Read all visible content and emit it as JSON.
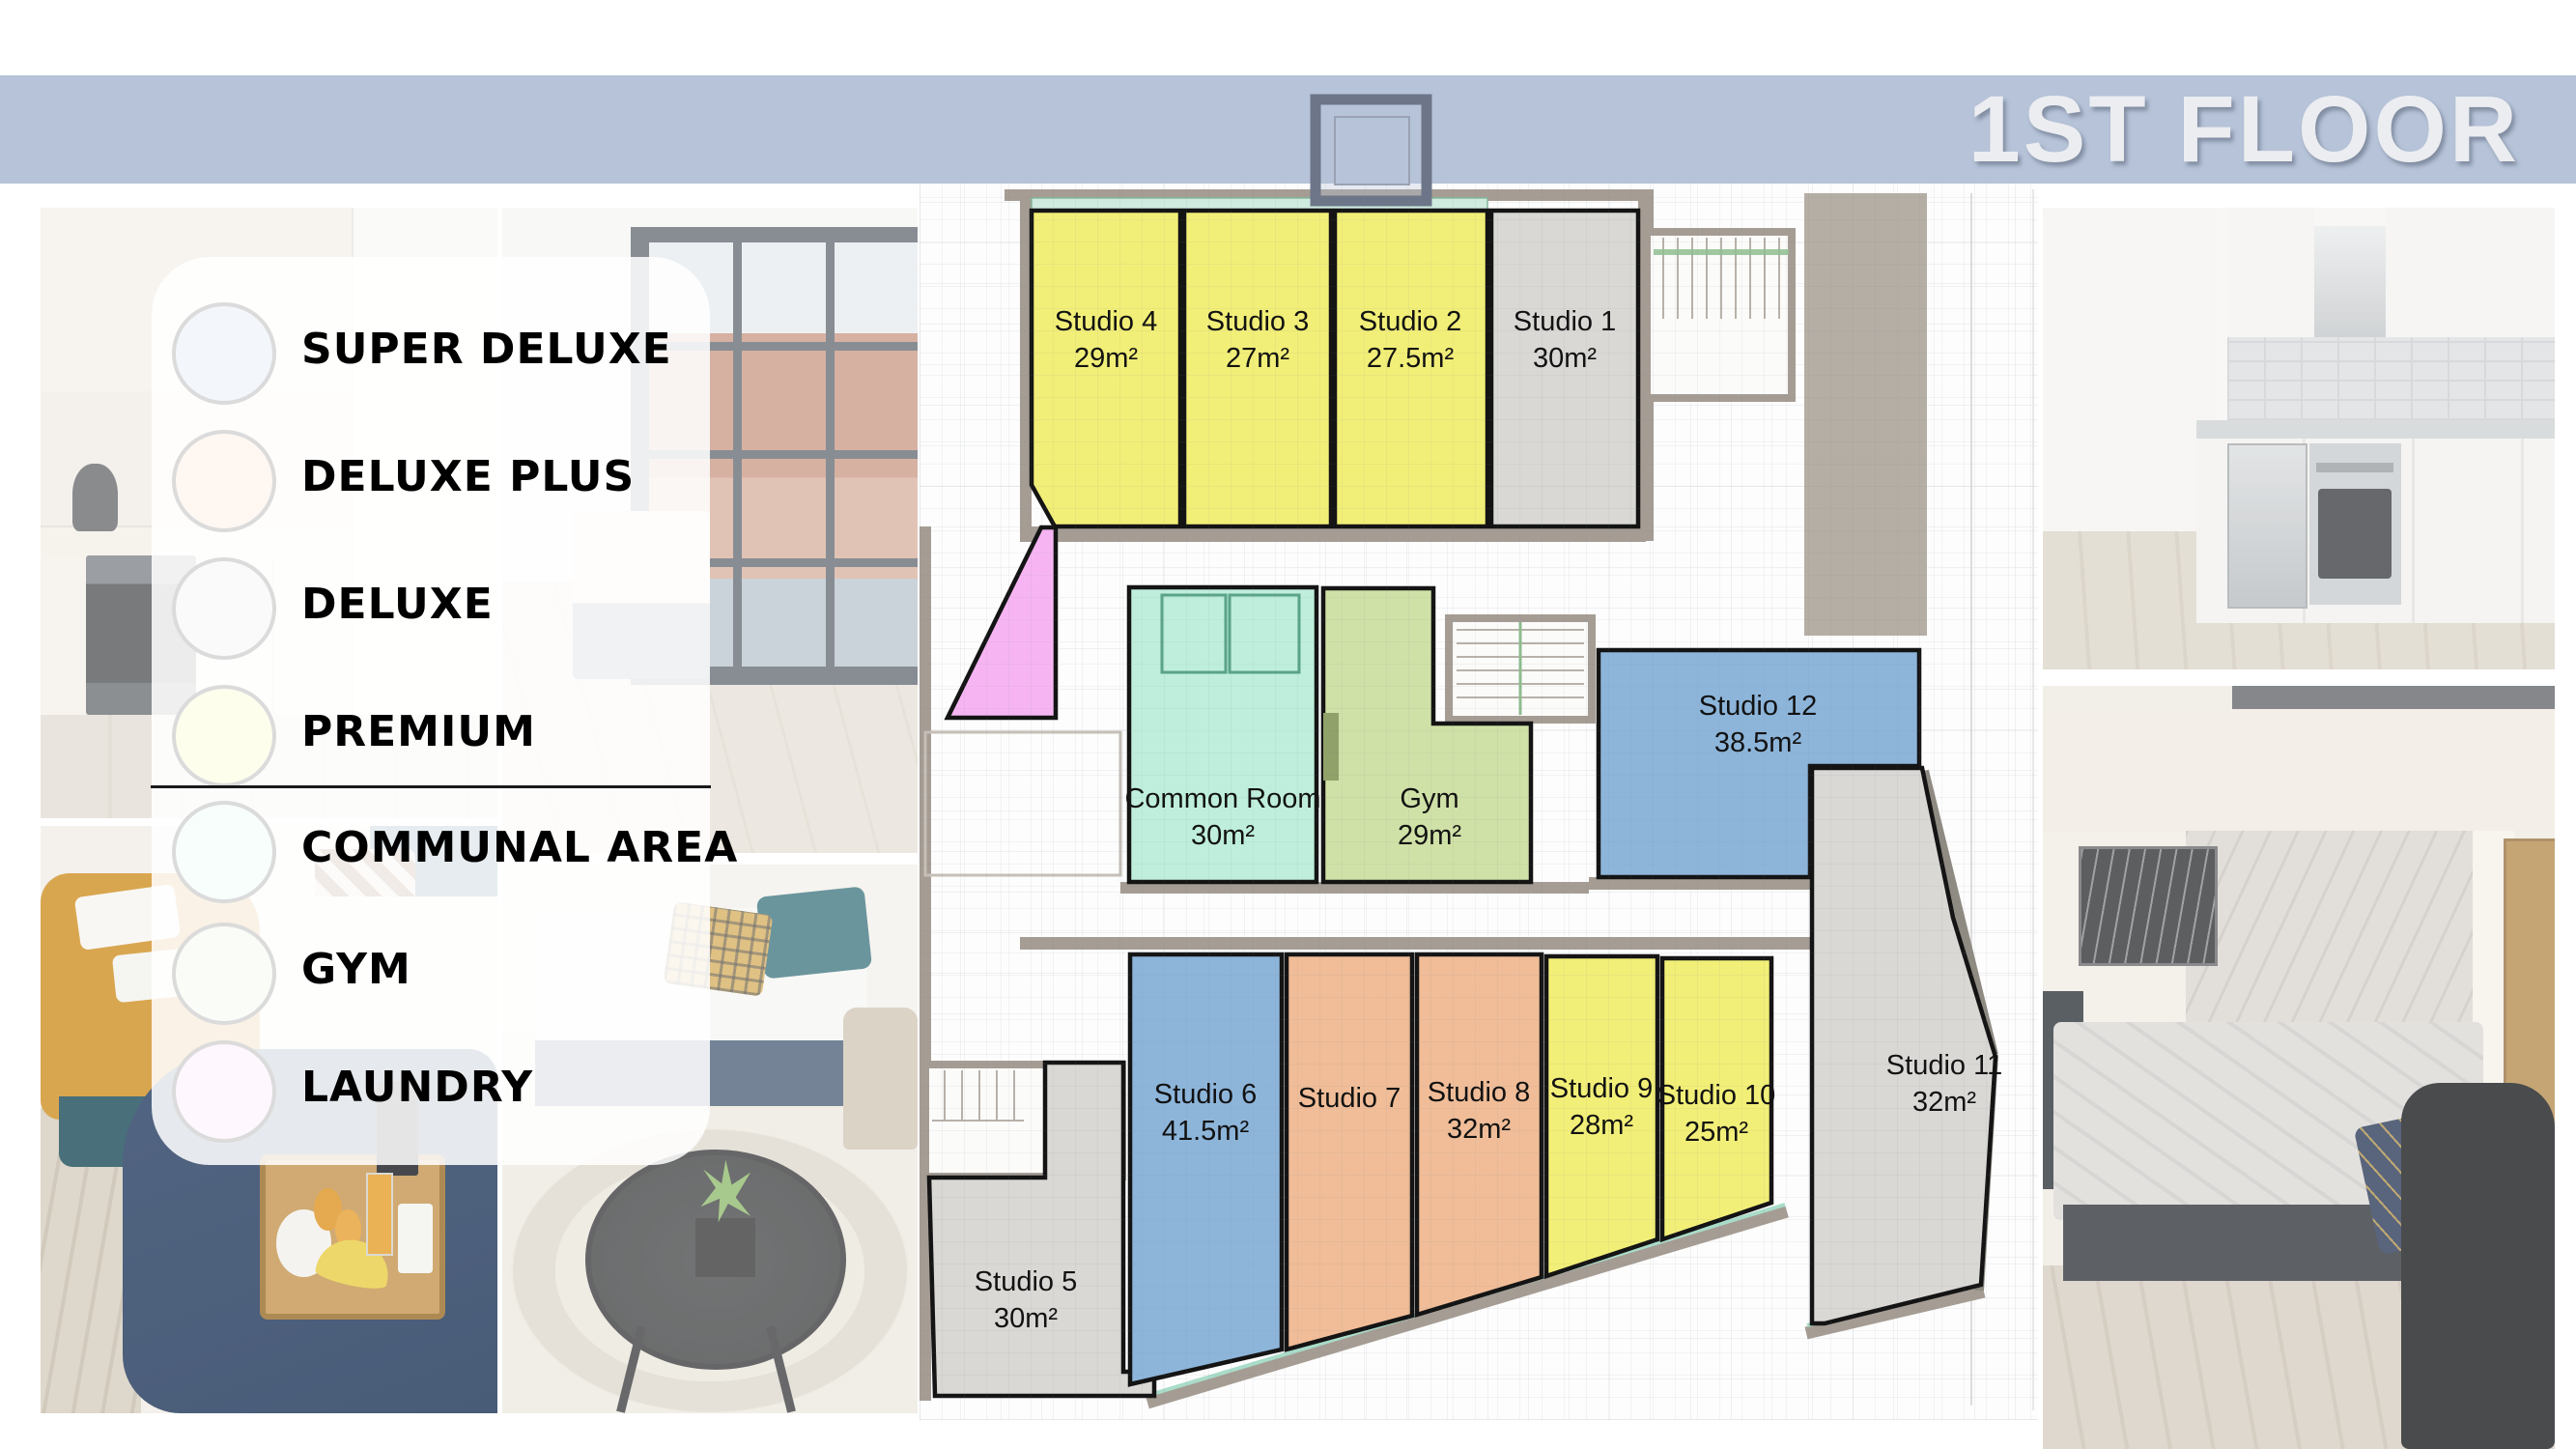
{
  "banner": {
    "title": "1ST FLOOR",
    "bg_color": "#b6c3d8",
    "text_color": "#ebedf1"
  },
  "legend": {
    "items": [
      {
        "id": "super-deluxe",
        "label": "SUPER DELUXE",
        "color": "#a9c7e3"
      },
      {
        "id": "deluxe-plus",
        "label": "DELUXE PLUS",
        "color": "#f8c7a2"
      },
      {
        "id": "deluxe",
        "label": "DELUXE",
        "color": "#d9d9d9"
      },
      {
        "id": "premium",
        "label": "PREMIUM",
        "color": "#f8f77d"
      },
      {
        "id": "communal-area",
        "label": "COMMUNAL AREA",
        "color": "#c5f6e3"
      },
      {
        "id": "gym",
        "label": "GYM",
        "color": "#d9e9c3"
      },
      {
        "id": "laundry",
        "label": "LAUNDRY",
        "color": "#fac3f8"
      }
    ]
  },
  "category_colors": {
    "premium": "#f2ef78",
    "deluxe": "#d9d8d5",
    "deluxe_plus": "#f0bd98",
    "super_deluxe": "#8db5da",
    "communal_area": "#bfefdc",
    "gym": "#d0e1a7",
    "laundry": "#f6b5f2"
  },
  "plan": {
    "rooms": [
      {
        "id": "studio-4",
        "name": "Studio 4",
        "area": "29m²",
        "category": "premium"
      },
      {
        "id": "studio-3",
        "name": "Studio 3",
        "area": "27m²",
        "category": "premium"
      },
      {
        "id": "studio-2",
        "name": "Studio 2",
        "area": "27.5m²",
        "category": "premium"
      },
      {
        "id": "studio-1",
        "name": "Studio 1",
        "area": "30m²",
        "category": "deluxe"
      },
      {
        "id": "studio-12",
        "name": "Studio 12",
        "area": "38.5m²",
        "category": "super_deluxe"
      },
      {
        "id": "common-room",
        "name": "Common Room",
        "area": "30m²",
        "category": "communal_area"
      },
      {
        "id": "gym",
        "name": "Gym",
        "area": "29m²",
        "category": "gym"
      },
      {
        "id": "laundry",
        "category": "laundry"
      },
      {
        "id": "studio-5",
        "name": "Studio 5",
        "area": "30m²",
        "category": "deluxe"
      },
      {
        "id": "studio-6",
        "name": "Studio 6",
        "area": "41.5m²",
        "category": "super_deluxe"
      },
      {
        "id": "studio-7",
        "name": "Studio 7",
        "category": "deluxe_plus"
      },
      {
        "id": "studio-8",
        "name": "Studio 8",
        "area": "32m²",
        "category": "deluxe_plus"
      },
      {
        "id": "studio-9",
        "name": "Studio 9",
        "area": "28m²",
        "category": "premium"
      },
      {
        "id": "studio-10",
        "name": "Studio 10",
        "area": "25m²",
        "category": "premium"
      },
      {
        "id": "studio-11",
        "name": "Studio 11",
        "area": "32m²",
        "category": "deluxe"
      }
    ]
  }
}
